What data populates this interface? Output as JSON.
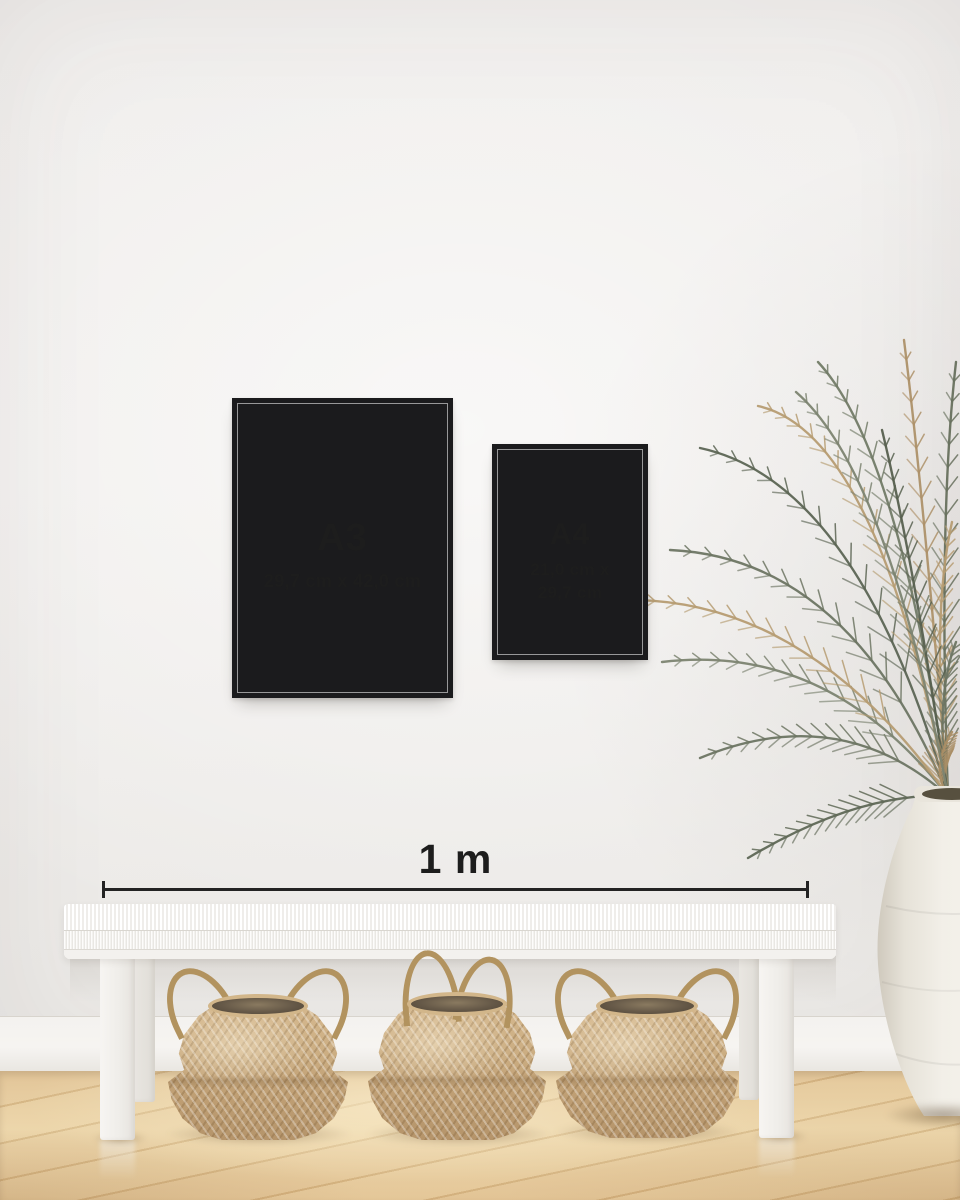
{
  "posters": [
    {
      "label": "A3",
      "dimensions": "29,7 cm x 42,0 cm"
    },
    {
      "label": "A4",
      "dimensions_line1": "21,0 cm x",
      "dimensions_line2": "29,7 cm"
    }
  ],
  "scale": {
    "label": "1 m"
  },
  "colors": {
    "frame": "#1b1b1d",
    "text": "#1d1d1d",
    "scale_line": "#232323",
    "wall": "#f0eeec",
    "baseboard": "#f2f0ed",
    "floor_wood": "#e3c693",
    "bench": "#f4f2ef",
    "basket": "#c9ab80",
    "basket_opening": "#5d5142",
    "plant_green": "#6d7563",
    "plant_tan": "#b69c72",
    "vase": "#efece5"
  }
}
